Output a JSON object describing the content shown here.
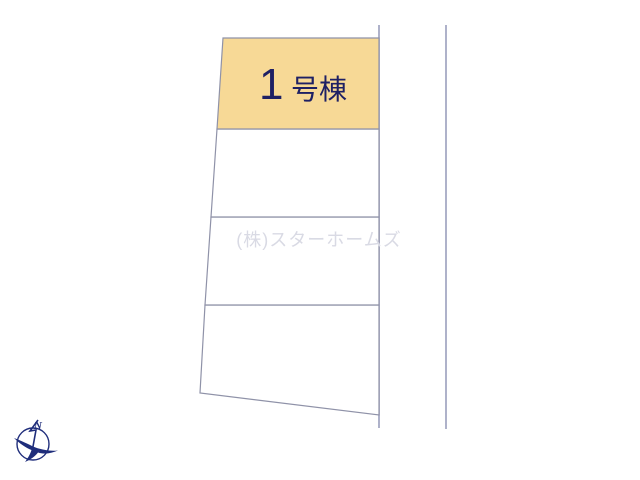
{
  "plot_map": {
    "lot1": {
      "number": "1",
      "suffix": "号棟",
      "label": "1号棟"
    },
    "lot_count": 4
  },
  "watermark": {
    "text": "(株)スターホームズ"
  },
  "compass": {
    "north_label": "N"
  },
  "colors": {
    "background": "#ffffff",
    "lot_fill": "#ffffff",
    "lot_highlight": "#F7D996",
    "lot_label_text": "#1e2064",
    "lot_line": "#8f92a8",
    "road_line": "#a6aac4",
    "watermark_text": "#d9dae4",
    "compass": "#1f2d7b"
  }
}
